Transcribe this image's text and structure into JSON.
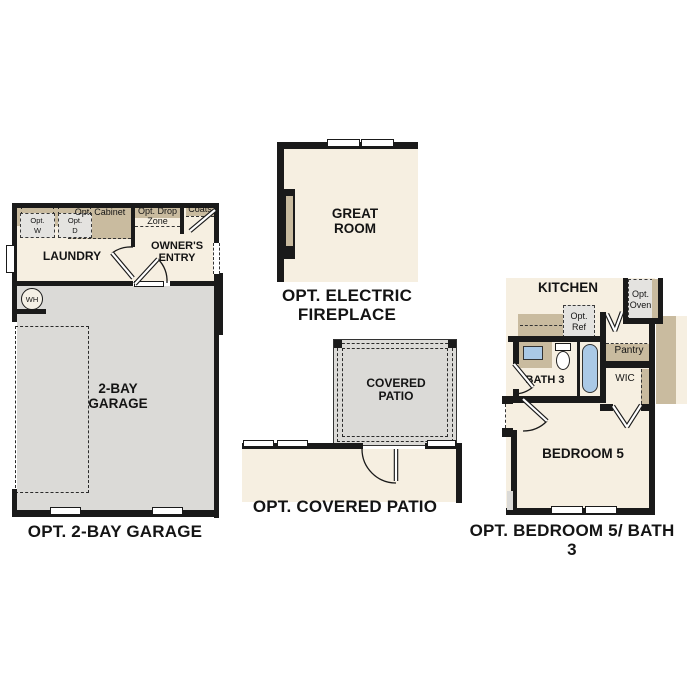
{
  "colors": {
    "wall": "#1a1a1a",
    "floor": "#f6efe1",
    "garage_floor": "#dbdad7",
    "cabinet_tan": "#c9bb9f",
    "fixture_blue": "#aac9e6",
    "opt_box": "#e4e3e0"
  },
  "plans": {
    "garage": {
      "caption": "OPT. 2-BAY GARAGE",
      "rooms": {
        "laundry": "LAUNDRY",
        "owners_entry": "OWNER'S ENTRY",
        "garage": "2-BAY GARAGE"
      },
      "labels": {
        "opt_cabinet": "Opt. Cabinet",
        "opt_drop_zone": "Opt. Drop Zone",
        "coats": "Coats",
        "opt_w": "Opt. W",
        "opt_d": "Opt. D",
        "water_heater": "WH"
      }
    },
    "great_room": {
      "caption": "OPT. ELECTRIC FIREPLACE",
      "rooms": {
        "great_room": "GREAT ROOM"
      }
    },
    "patio": {
      "caption": "OPT. COVERED PATIO",
      "rooms": {
        "covered_patio": "COVERED PATIO"
      }
    },
    "bedroom": {
      "caption": "OPT. BEDROOM 5/ BATH 3",
      "rooms": {
        "kitchen": "KITCHEN",
        "bath3": "BATH 3",
        "wic": "WIC",
        "bedroom5": "BEDROOM 5",
        "pantry": "Pantry"
      },
      "labels": {
        "opt_ref": "Opt. Ref",
        "opt_oven": "Opt. Oven"
      }
    }
  }
}
